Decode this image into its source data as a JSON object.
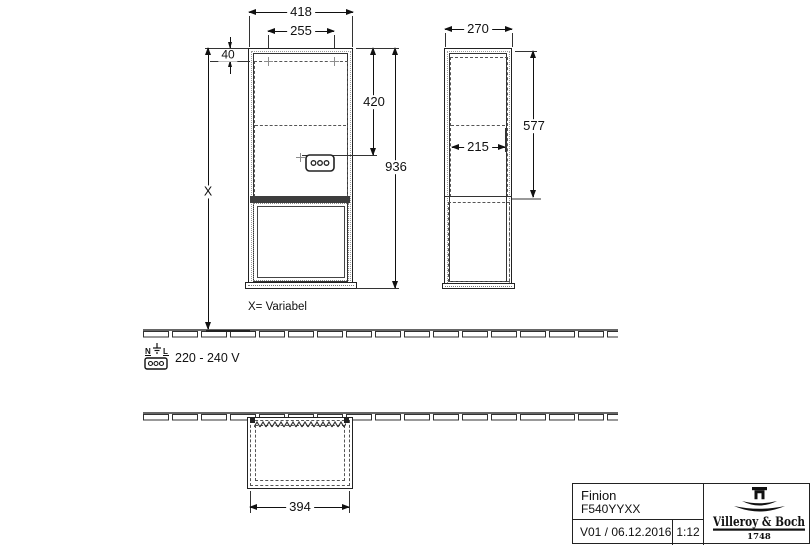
{
  "front_view": {
    "dim_width_total": "418",
    "dim_width_inner": "255",
    "dim_top_offset": "40",
    "dim_socket_height": "420",
    "dim_total_height": "936",
    "dim_variable": "X",
    "note_variable": "X= Variabel"
  },
  "side_view": {
    "dim_depth": "270",
    "dim_depth_inner": "215",
    "dim_upper_height": "577"
  },
  "plan_view": {
    "dim_width": "394"
  },
  "electrical": {
    "terminal_n": "N",
    "terminal_l": "L",
    "voltage": "220 - 240 V"
  },
  "title_block": {
    "product": "Finion",
    "article_number": "F540YYXX",
    "version_date": "V01 / 06.12.2016",
    "scale": "1:12",
    "brand": "Villeroy & Boch",
    "brand_year": "1748"
  },
  "colors": {
    "line": "#222222",
    "dashed": "#555555",
    "background": "#ffffff"
  }
}
